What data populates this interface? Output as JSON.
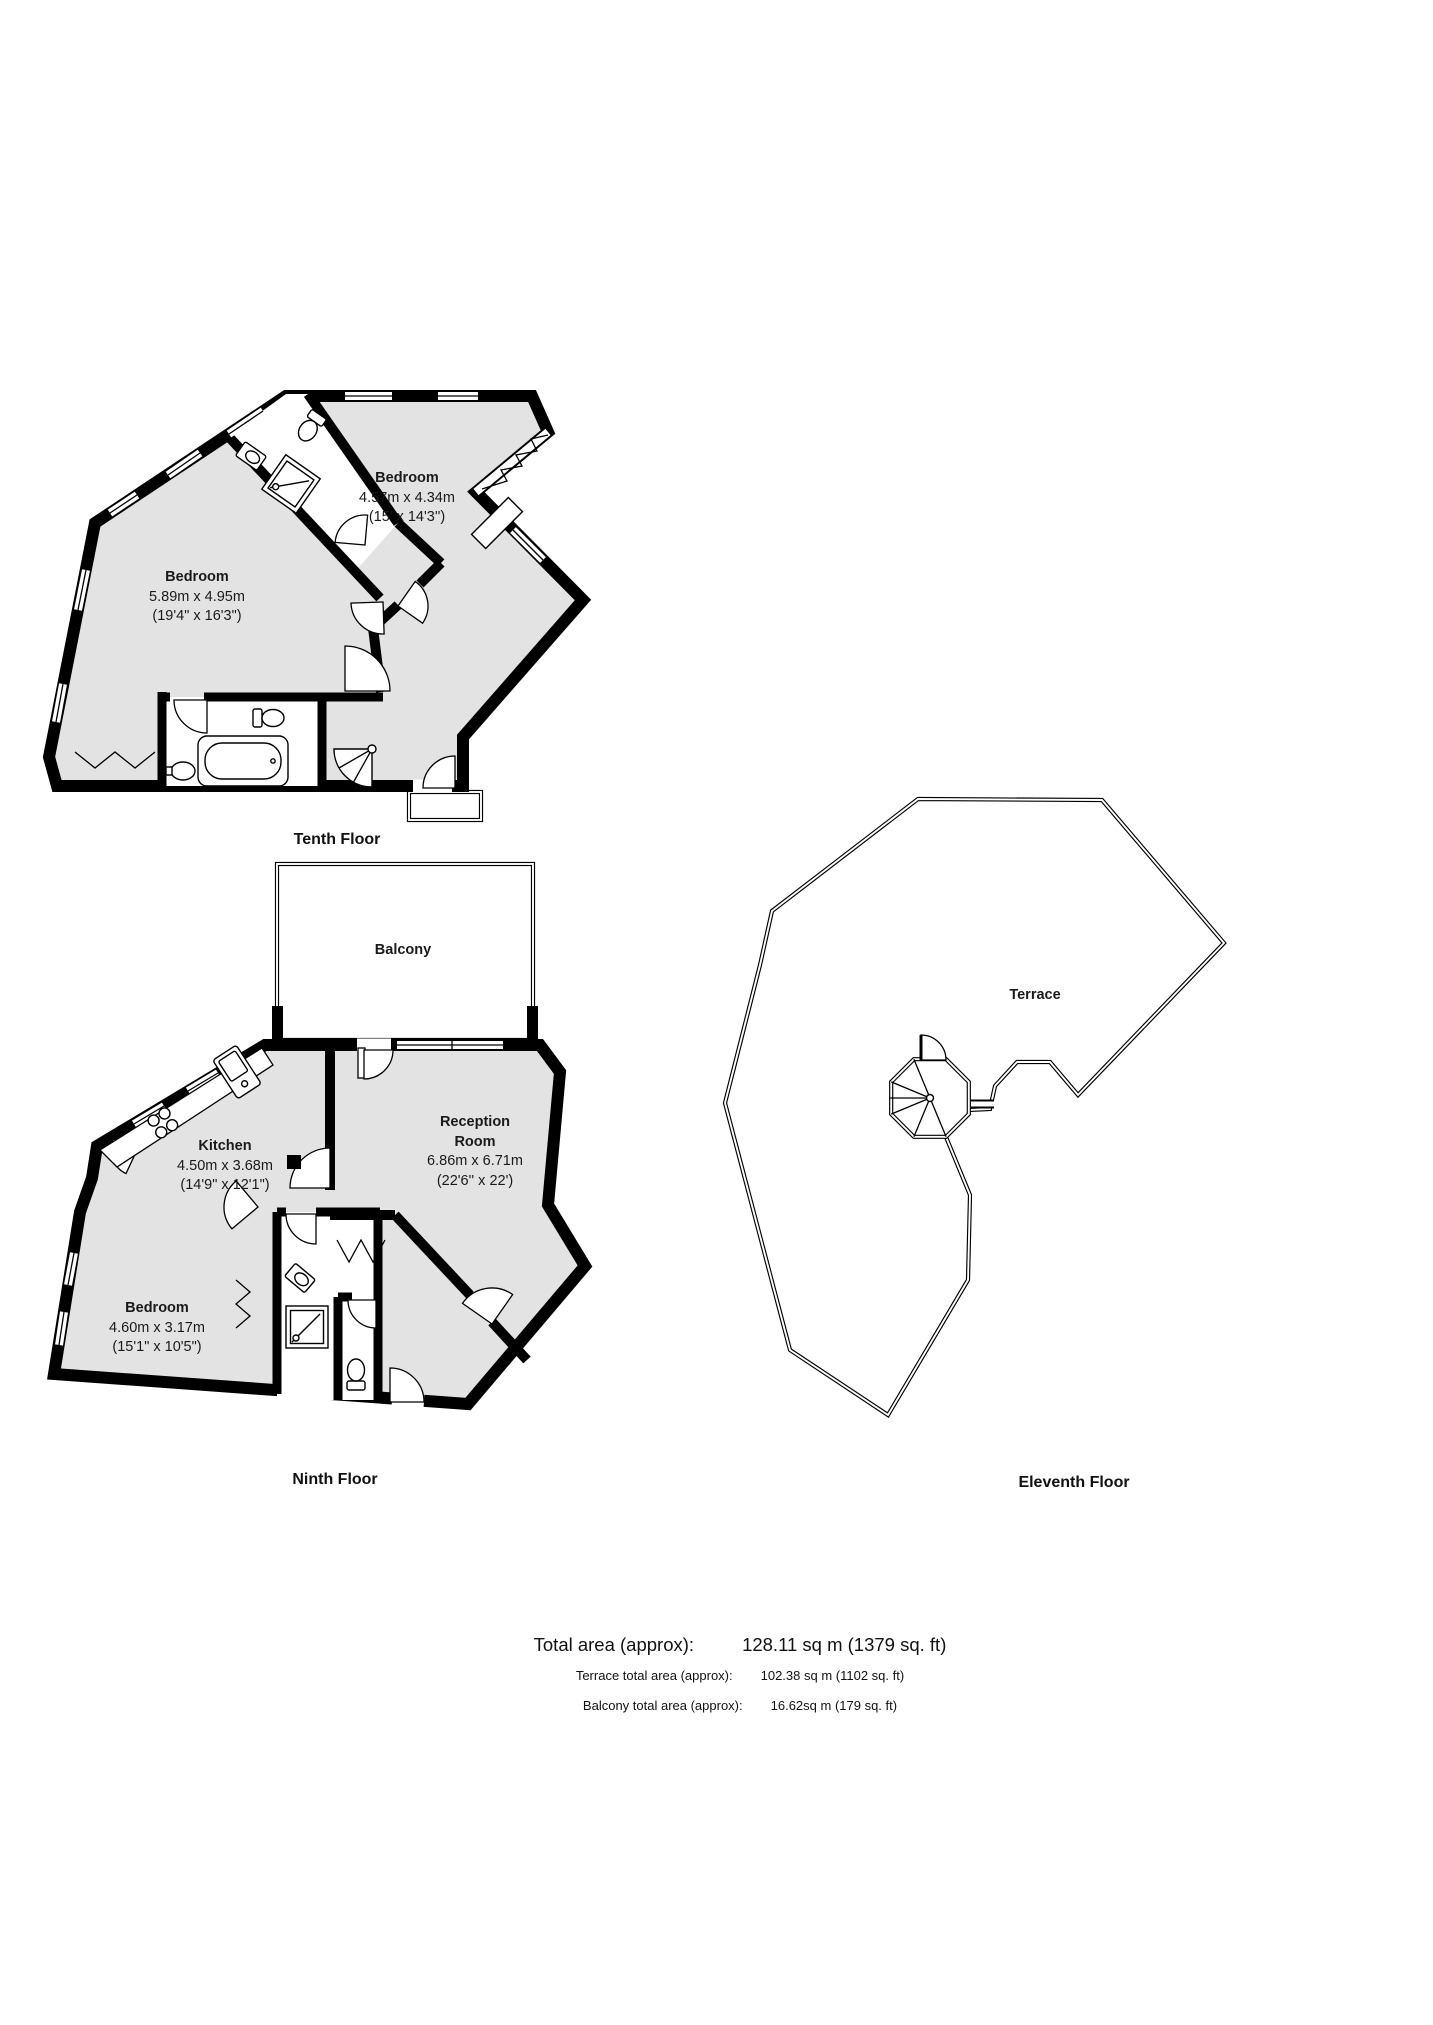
{
  "document": {
    "type": "property-floorplan"
  },
  "colors": {
    "background": "#ffffff",
    "wall": "#000000",
    "room_fill": "#e3e3e3"
  },
  "fixtures": [
    "toilet-icon",
    "sink-icon",
    "shower-icon",
    "bathtub-icon",
    "corner-shower-icon",
    "kitchen-sink-icon",
    "hob-icon",
    "spiral-staircase-icon"
  ],
  "floors": {
    "tenth": {
      "label": "Tenth Floor",
      "rooms": {
        "bedroom_right": {
          "name": "Bedroom",
          "metric": "4.57m x 4.34m",
          "imperial": "(15' x 14'3'')"
        },
        "bedroom_left": {
          "name": "Bedroom",
          "metric": "5.89m x 4.95m",
          "imperial": "(19'4\" x 16'3\")"
        }
      }
    },
    "ninth": {
      "label": "Ninth Floor",
      "rooms": {
        "balcony": {
          "name": "Balcony"
        },
        "kitchen": {
          "name": "Kitchen",
          "metric": "4.50m x 3.68m",
          "imperial": "(14'9\" x 12'1\")"
        },
        "reception": {
          "name_line1": "Reception",
          "name_line2": "Room",
          "metric": "6.86m x 6.71m",
          "imperial": "(22'6'' x 22')"
        },
        "bedroom": {
          "name": "Bedroom",
          "metric": "4.60m x 3.17m",
          "imperial": "(15'1\" x 10'5\")"
        }
      }
    },
    "eleventh": {
      "label": "Eleventh Floor",
      "rooms": {
        "terrace": {
          "name": "Terrace"
        }
      }
    }
  },
  "totals": {
    "total": {
      "label": "Total area (approx):",
      "value": "128.11 sq m (1379 sq. ft)"
    },
    "terrace": {
      "label": "Terrace total area (approx):",
      "value": "102.38 sq m (1102 sq. ft)"
    },
    "balcony": {
      "label": "Balcony total area (approx):",
      "value": "16.62sq m (179 sq. ft)"
    }
  }
}
